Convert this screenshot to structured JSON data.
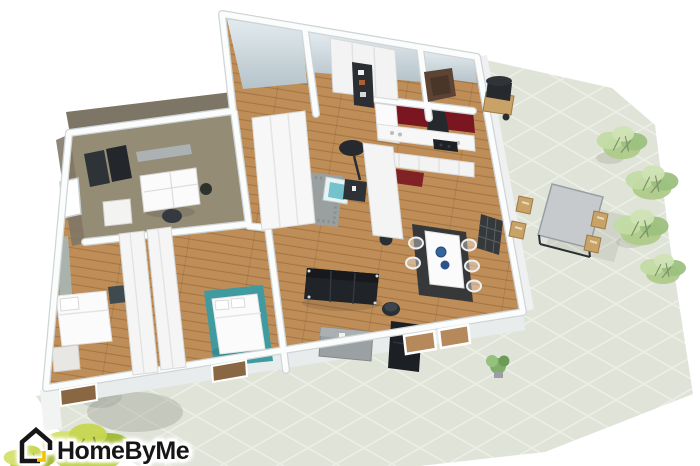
{
  "watermark": {
    "brand": "HomeByMe"
  },
  "palette": {
    "bg": "#ffffff",
    "patio": "#e0e4d8",
    "patio_line": "#edf0e7",
    "wood": "#bf8e58",
    "wall": "#fbfcfc",
    "wall_edge": "#cfd5d7",
    "wall_face_top": "#e3ebef",
    "wall_face_bottom": "#b5c3ca",
    "bath_wall": "#7d7667",
    "bath_floor": "#948c75",
    "kitchen_wall": "#7a1620",
    "accent_wall": "#a9b3ac",
    "teal_rug": "#3f9ba0",
    "rug_dark": "#2f3438",
    "rug_grey": "#9aa0a0",
    "furniture_black": "#202327",
    "furniture_white": "#fbfbfb",
    "furniture_grey": "#9ba0a3",
    "armchair_brown": "#5d4334",
    "outdoor_wood": "#c9a267",
    "shrub_green": "#aecb8a",
    "potted_plant_green": "#b9cf45",
    "logo_black": "#161616",
    "logo_yellow": "#f0c400"
  },
  "scene": {
    "type": "3d-floor-plan-render",
    "rooms": [
      "bathroom",
      "hallway",
      "storage-room",
      "entry",
      "kitchen",
      "dining-area",
      "living-room",
      "reading-nook",
      "bedroom-1",
      "bedroom-2"
    ],
    "furniture": [
      "double-sink-vanity",
      "bathroom-radiator",
      "mirror",
      "stool",
      "single-bed",
      "double-bed",
      "wardrobe",
      "sliding-door-closet",
      "dresser",
      "shag-rug",
      "teal-armchair",
      "floor-lamp",
      "side-table",
      "fridge",
      "range-hood",
      "cooktop",
      "kitchen-counter",
      "kitchen-island",
      "kitchen-mat",
      "dining-table",
      "dining-chairs",
      "bowls",
      "sofa",
      "lounge-chair",
      "round-side-table",
      "sideboard",
      "indoor-plant"
    ],
    "outdoor": [
      "tiled-patio",
      "outdoor-dining-table",
      "outdoor-chairs",
      "barbecue-grill",
      "shrubs",
      "potted-plant"
    ]
  }
}
